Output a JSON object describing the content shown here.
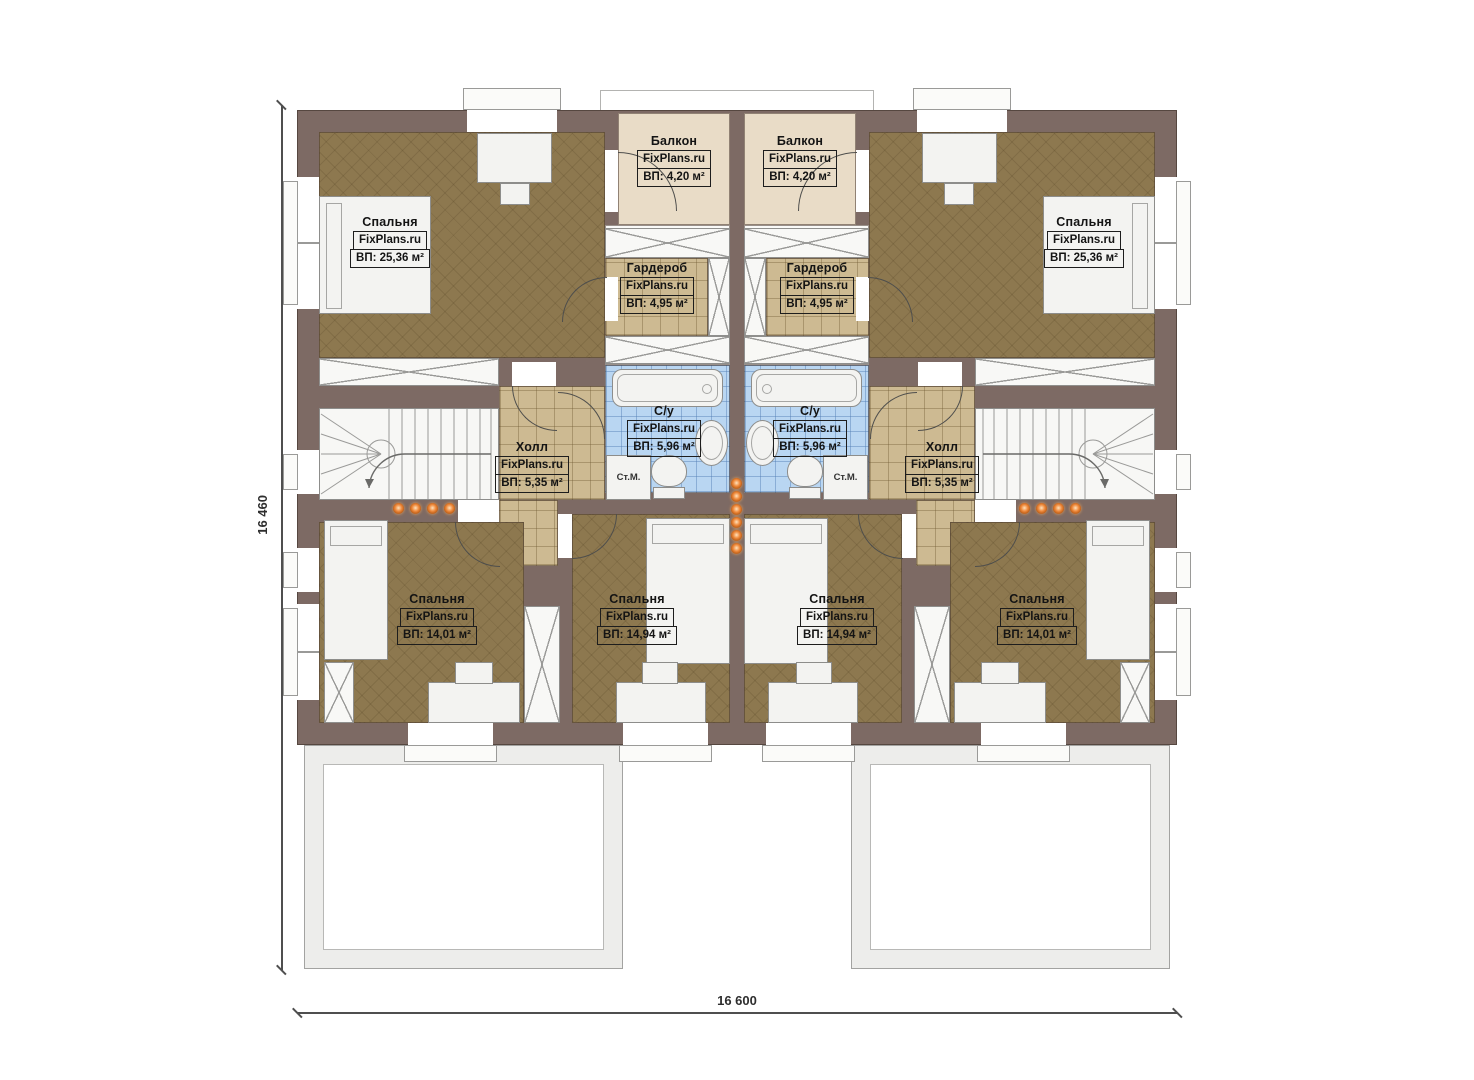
{
  "brand": "FixPlans.ru",
  "dimensions": {
    "height_label": "16 460",
    "width_label": "16 600"
  },
  "rooms": {
    "balcony_left": {
      "name": "Балкон",
      "area": "ВП: 4,20 м²"
    },
    "balcony_right": {
      "name": "Балкон",
      "area": "ВП: 4,20 м²"
    },
    "bedroom_master_left": {
      "name": "Спальня",
      "area": "ВП: 25,36 м²"
    },
    "bedroom_master_right": {
      "name": "Спальня",
      "area": "ВП: 25,36 м²"
    },
    "wardrobe_left": {
      "name": "Гардероб",
      "area": "ВП: 4,95 м²"
    },
    "wardrobe_right": {
      "name": "Гардероб",
      "area": "ВП: 4,95 м²"
    },
    "bath_left": {
      "name": "С/у",
      "area": "ВП: 5,96 м²"
    },
    "bath_right": {
      "name": "С/у",
      "area": "ВП: 5,96 м²"
    },
    "hall_left": {
      "name": "Холл",
      "area": "ВП: 5,35 м²"
    },
    "hall_right": {
      "name": "Холл",
      "area": "ВП: 5,35 м²"
    },
    "bedroom_sw": {
      "name": "Спальня",
      "area": "ВП: 14,01 м²"
    },
    "bedroom_scl": {
      "name": "Спальня",
      "area": "ВП: 14,94 м²"
    },
    "bedroom_scr": {
      "name": "Спальня",
      "area": "ВП: 14,94 м²"
    },
    "bedroom_se": {
      "name": "Спальня",
      "area": "ВП: 14,01 м²"
    }
  },
  "appliances": {
    "washer_left": "Ст.М.",
    "washer_right": "Ст.М."
  },
  "colors": {
    "wall": "#7d6a64",
    "wall_edge": "#564740",
    "floor_bedroom": "#8d784f",
    "floor_hall": "#cdba92",
    "floor_bath": "#b9d6f2",
    "floor_balcony": "#e9dcc7",
    "fixture": "#f3f3f1",
    "light_dot": "#ef8a3c",
    "dim_line": "#4f4f4f",
    "terrace": "#ededeb"
  }
}
